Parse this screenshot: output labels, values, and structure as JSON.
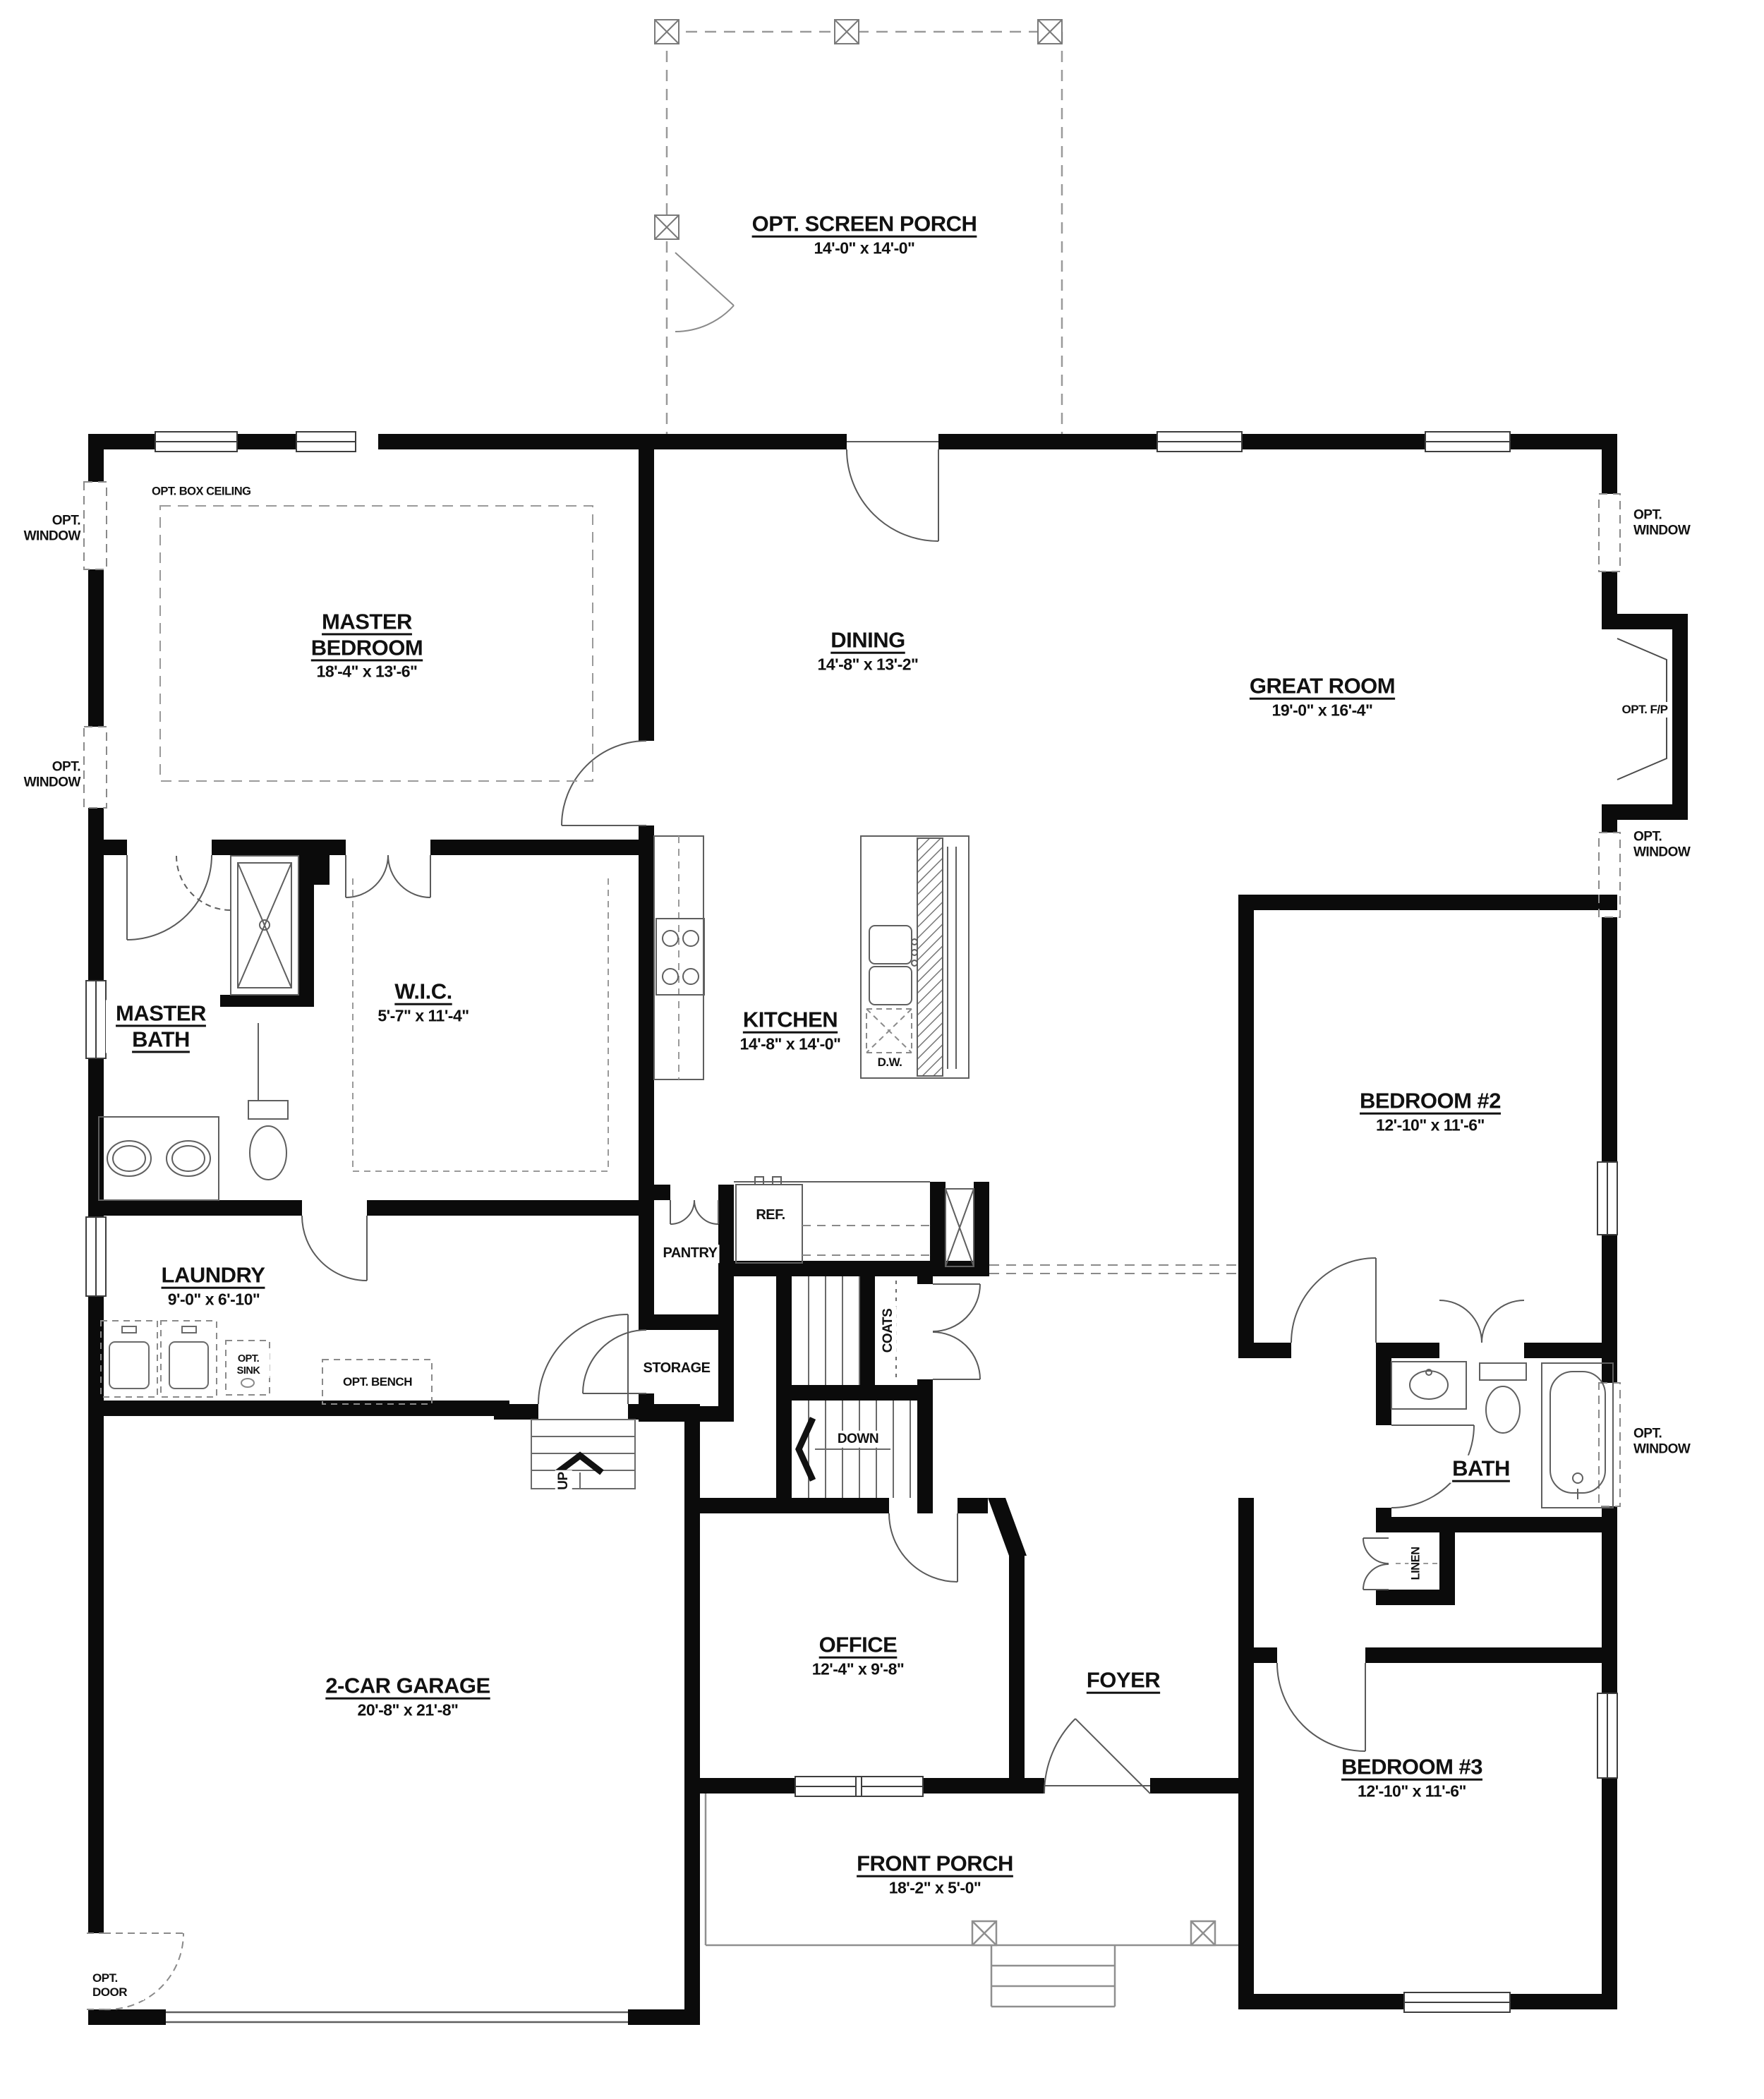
{
  "plan": {
    "rooms": {
      "screen_porch": {
        "label": "OPT. SCREEN PORCH",
        "dims": "14'-0\" x 14'-0\""
      },
      "master_bedroom": {
        "label": "MASTER BEDROOM",
        "dims": "18'-4\" x 13'-6\""
      },
      "dining": {
        "label": "DINING",
        "dims": "14'-8\" x 13'-2\""
      },
      "great_room": {
        "label": "GREAT ROOM",
        "dims": "19'-0\" x 16'-4\""
      },
      "master_bath": {
        "label": "MASTER BATH"
      },
      "wic": {
        "label": "W.I.C.",
        "dims": "5'-7\" x 11'-4\""
      },
      "kitchen": {
        "label": "KITCHEN",
        "dims": "14'-8\" x 14'-0\""
      },
      "bedroom_2": {
        "label": "BEDROOM #2",
        "dims": "12'-10\" x 11'-6\""
      },
      "laundry": {
        "label": "LAUNDRY",
        "dims": "9'-0\" x 6'-10\""
      },
      "pantry": {
        "label": "PANTRY"
      },
      "storage": {
        "label": "STORAGE"
      },
      "coats": {
        "label": "COATS"
      },
      "bath": {
        "label": "BATH"
      },
      "linen": {
        "label": "LINEN"
      },
      "garage": {
        "label": "2-CAR GARAGE",
        "dims": "20'-8\" x 21'-8\""
      },
      "office": {
        "label": "OFFICE",
        "dims": "12'-4\" x 9'-8\""
      },
      "foyer": {
        "label": "FOYER"
      },
      "bedroom_3": {
        "label": "BEDROOM #3",
        "dims": "12'-10\" x 11'-6\""
      },
      "front_porch": {
        "label": "FRONT PORCH",
        "dims": "18'-2\" x 5'-0\""
      }
    },
    "annotations": {
      "opt_window": "OPT. WINDOW",
      "opt_door": "OPT. DOOR",
      "opt_box_ceiling": "OPT. BOX CEILING",
      "opt_fp": "OPT. F/P",
      "opt_sink": "OPT. SINK",
      "opt_bench": "OPT. BENCH",
      "ref": "REF.",
      "dw": "D.W.",
      "down": "DOWN",
      "up": "UP"
    },
    "colors": {
      "wall": "#0b0b0b",
      "line": "#4a4a4a",
      "dash": "#8a8a8a",
      "text": "#111111"
    }
  }
}
